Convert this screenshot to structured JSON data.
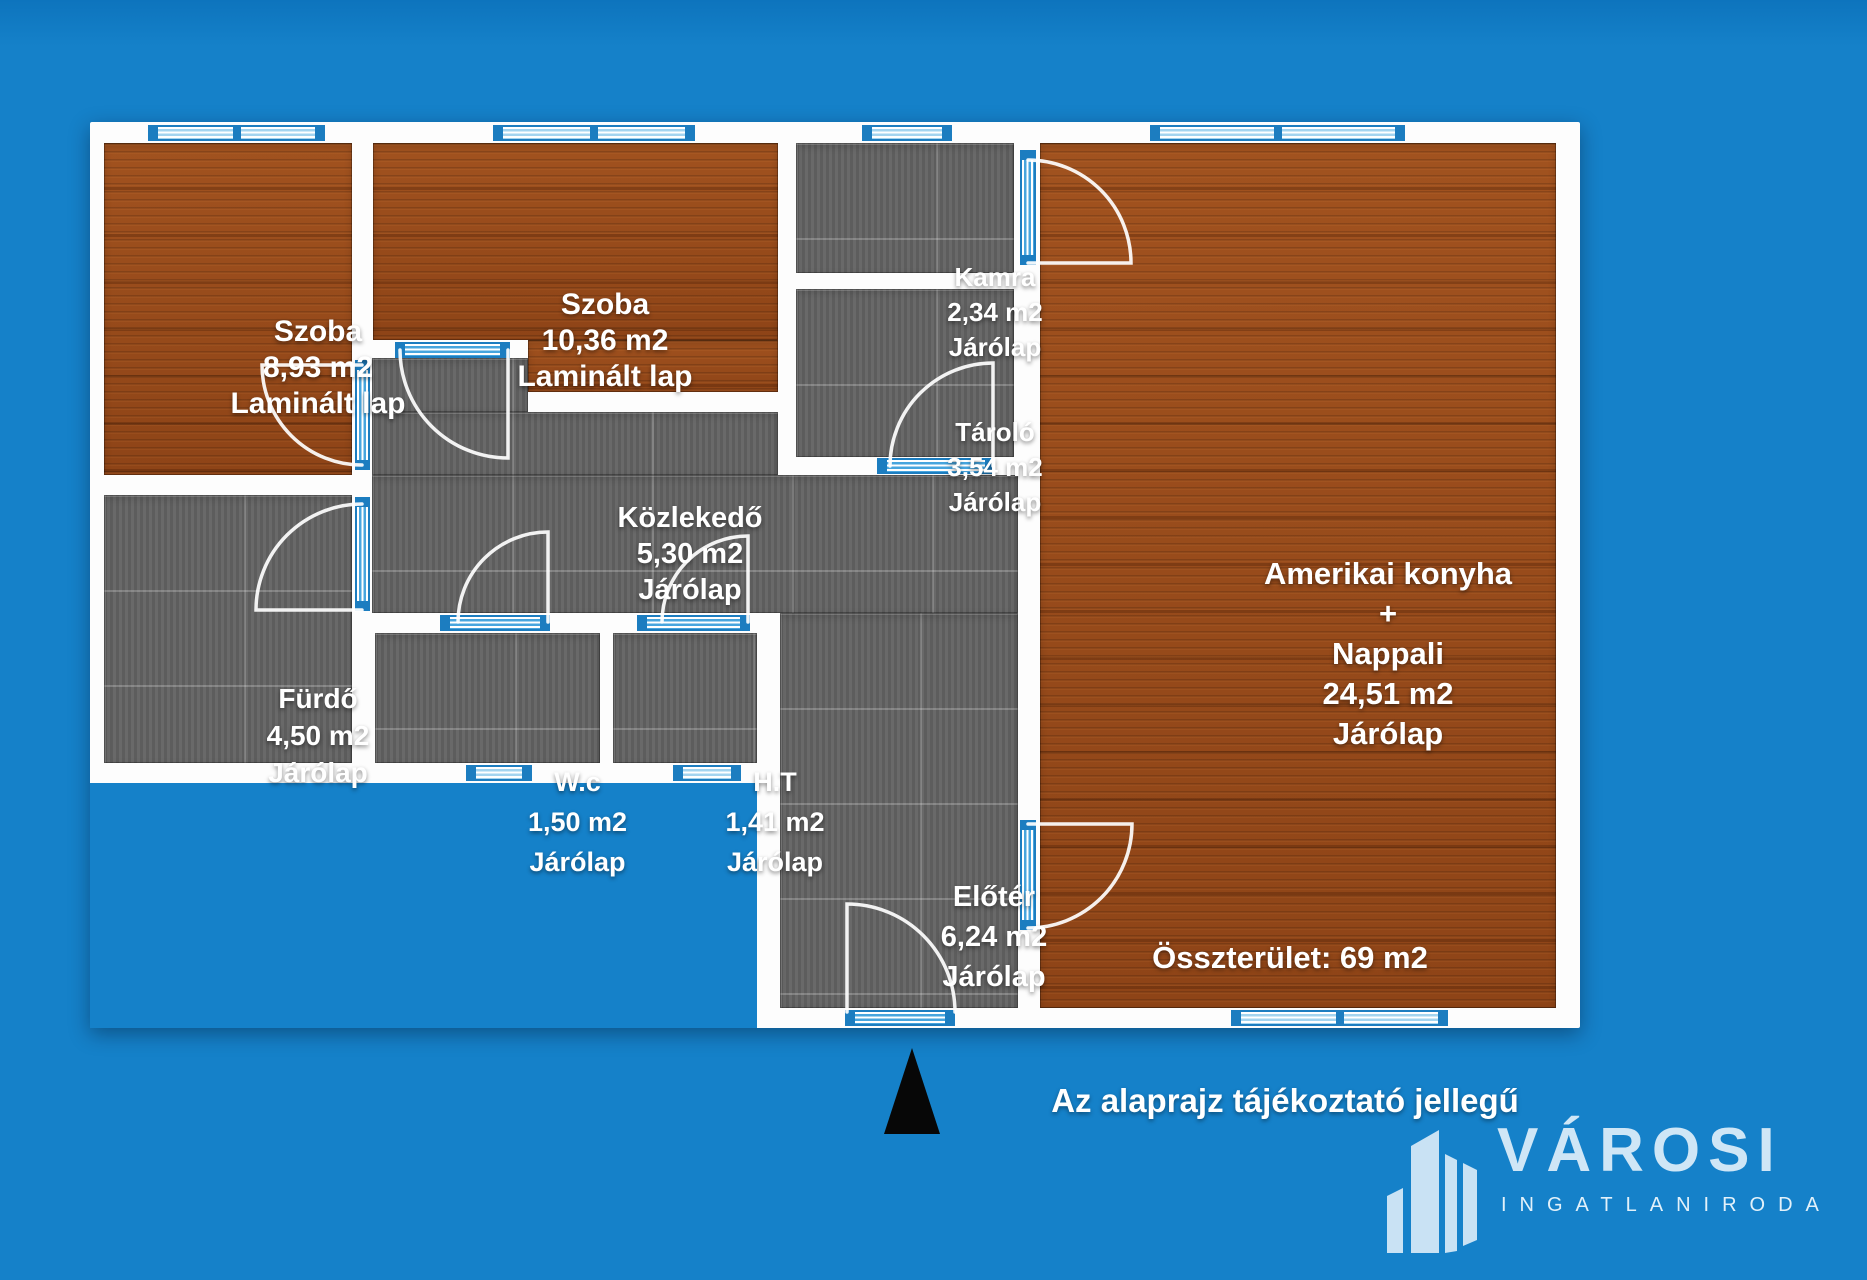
{
  "plan": {
    "rooms": {
      "szoba1": {
        "name": "Szoba",
        "area": "8,93 m2",
        "floor": "Laminált lap"
      },
      "szoba2": {
        "name": "Szoba",
        "area": "10,36 m2",
        "floor": "Laminált lap"
      },
      "kamra": {
        "name": "Kamra",
        "area": "2,34 m2",
        "floor": "Járólap"
      },
      "tarolo": {
        "name": "Tároló",
        "area": "3,54 m2",
        "floor": "Járólap"
      },
      "nappali": {
        "name_line1": "Amerikai konyha",
        "name_line2": "+",
        "name_line3": "Nappali",
        "area": "24,51 m2",
        "floor": "Járólap"
      },
      "kozlekedo": {
        "name": "Közlekedő",
        "area": "5,30 m2",
        "floor": "Járólap"
      },
      "furdo": {
        "name": "Fürdő",
        "area": "4,50 m2",
        "floor": "Járólap"
      },
      "wc": {
        "name": "W.c",
        "area": "1,50 m2",
        "floor": "Járólap"
      },
      "ht": {
        "name": "H.T",
        "area": "1,41 m2",
        "floor": "Járólap"
      },
      "eloter": {
        "name": "Előtér",
        "area": "6,24 m2",
        "floor": "Járólap"
      }
    },
    "total_label": "Összterület: 69 m2",
    "disclaimer": "Az alaprajz tájékoztató jellegű"
  },
  "branding": {
    "name": "VÁROSI",
    "subtitle": "INGATLANIRODA",
    "logo_color": "#cfe6f6"
  },
  "icons": {
    "north_arrow": "north-arrow-triangle",
    "brand_logo": "city-buildings"
  },
  "colors": {
    "background": "#1581c9",
    "wall": "#fdfdfd",
    "wood_floor": "#9a4c1c",
    "tile_floor": "#646464",
    "opening_blue": "#1c7dc0",
    "label_text": "#ffffff"
  }
}
